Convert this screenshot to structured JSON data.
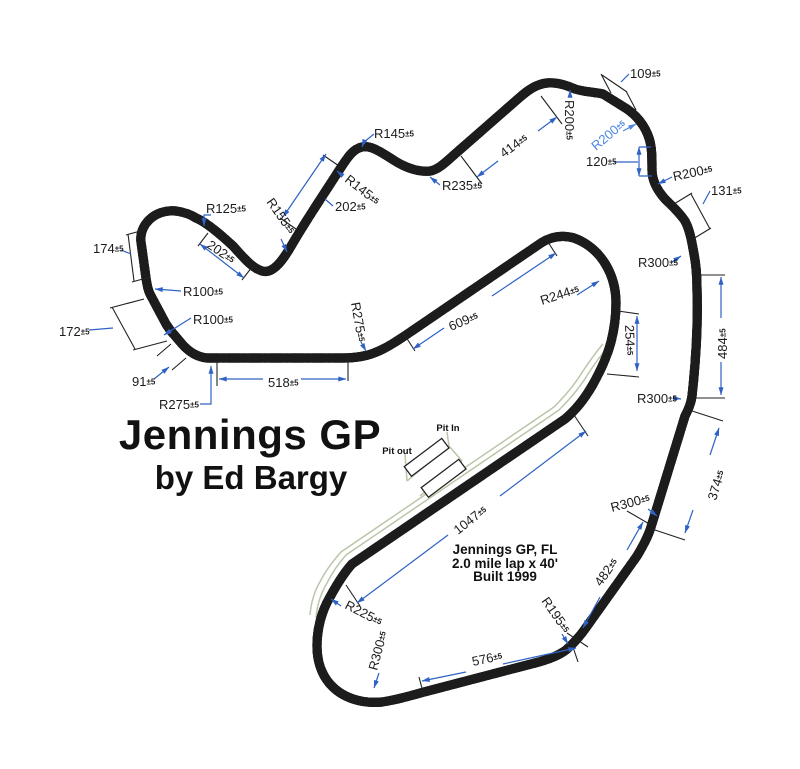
{
  "title": {
    "line1": "Jennings GP",
    "line2": "by Ed Bargy"
  },
  "info": {
    "line1": "Jennings GP, FL",
    "line2": "2.0 mile lap x 40'",
    "line3": "Built 1999"
  },
  "pit": {
    "in": "Pit In",
    "out": "Pit out"
  },
  "tolerance": "±5",
  "colors": {
    "dimension_blue": "#2f62c4",
    "highlight_blue": "#4f86e3",
    "track_black": "#1c1c1c",
    "pit_green": "#b9c7a8"
  },
  "annotations": [
    {
      "id": "dim-174",
      "text": "174",
      "x": 93,
      "y": 253,
      "rot": 0
    },
    {
      "id": "dim-172",
      "text": "172",
      "x": 59,
      "y": 336,
      "rot": 0
    },
    {
      "id": "dim-91",
      "text": "91",
      "x": 132,
      "y": 386,
      "rot": 0
    },
    {
      "id": "r275-west",
      "text": "R275",
      "x": 159,
      "y": 409,
      "rot": 0
    },
    {
      "id": "r100-a",
      "text": "R100",
      "x": 183,
      "y": 296,
      "rot": 0
    },
    {
      "id": "r100-b",
      "text": "R100",
      "x": 193,
      "y": 324,
      "rot": 0
    },
    {
      "id": "r125",
      "text": "R125",
      "x": 206,
      "y": 213,
      "rot": 0
    },
    {
      "id": "dim-202-a",
      "text": "202",
      "x": 206,
      "y": 247,
      "rot": 34
    },
    {
      "id": "r155",
      "text": "R155",
      "x": 266,
      "y": 202,
      "rot": 55
    },
    {
      "id": "r145-rot",
      "text": "R145",
      "x": 344,
      "y": 181,
      "rot": 38
    },
    {
      "id": "dim-202-b",
      "text": "202",
      "x": 335,
      "y": 211,
      "rot": 0
    },
    {
      "id": "r145-top",
      "text": "R145",
      "x": 374,
      "y": 138,
      "rot": 0
    },
    {
      "id": "r235",
      "text": "R235",
      "x": 442,
      "y": 190,
      "rot": 0
    },
    {
      "id": "dim-414",
      "text": "414",
      "x": 504,
      "y": 158,
      "rot": -36
    },
    {
      "id": "r200-vert",
      "text": "R200",
      "x": 565,
      "y": 100,
      "rot": 90
    },
    {
      "id": "dim-109",
      "text": "109",
      "x": 630,
      "y": 78,
      "rot": 0
    },
    {
      "id": "r200-blue",
      "text": "R200",
      "x": 596,
      "y": 151,
      "rot": -40,
      "color": "highlight"
    },
    {
      "id": "dim-120",
      "text": "120",
      "x": 586,
      "y": 166,
      "rot": 0
    },
    {
      "id": "r200-c",
      "text": "R200",
      "x": 674,
      "y": 181,
      "rot": -12
    },
    {
      "id": "dim-131",
      "text": "131",
      "x": 711,
      "y": 195,
      "rot": 0
    },
    {
      "id": "r300-a",
      "text": "R300",
      "x": 638,
      "y": 267,
      "rot": 0
    },
    {
      "id": "dim-484",
      "text": "484",
      "x": 727,
      "y": 359,
      "rot": -90
    },
    {
      "id": "r300-b",
      "text": "R300",
      "x": 637,
      "y": 403,
      "rot": 0
    },
    {
      "id": "dim-374",
      "text": "374",
      "x": 716,
      "y": 501,
      "rot": -73
    },
    {
      "id": "r300-c",
      "text": "R300",
      "x": 612,
      "y": 512,
      "rot": -15
    },
    {
      "id": "dim-482",
      "text": "482",
      "x": 601,
      "y": 587,
      "rot": -55
    },
    {
      "id": "r195",
      "text": "R195",
      "x": 541,
      "y": 601,
      "rot": 55
    },
    {
      "id": "dim-576",
      "text": "576",
      "x": 473,
      "y": 666,
      "rot": -12
    },
    {
      "id": "r300-d",
      "text": "R300",
      "x": 377,
      "y": 671,
      "rot": -75
    },
    {
      "id": "r225",
      "text": "R225",
      "x": 344,
      "y": 608,
      "rot": 27
    },
    {
      "id": "dim-1047",
      "text": "1047",
      "x": 458,
      "y": 535,
      "rot": -38
    },
    {
      "id": "dim-609",
      "text": "609",
      "x": 451,
      "y": 331,
      "rot": -23
    },
    {
      "id": "r244",
      "text": "R244",
      "x": 542,
      "y": 305,
      "rot": -18
    },
    {
      "id": "dim-254",
      "text": "254",
      "x": 625,
      "y": 325,
      "rot": 88
    },
    {
      "id": "dim-518",
      "text": "518",
      "x": 268,
      "y": 387,
      "rot": 0
    },
    {
      "id": "r275-mid",
      "text": "R275",
      "x": 351,
      "y": 303,
      "rot": 80
    }
  ]
}
